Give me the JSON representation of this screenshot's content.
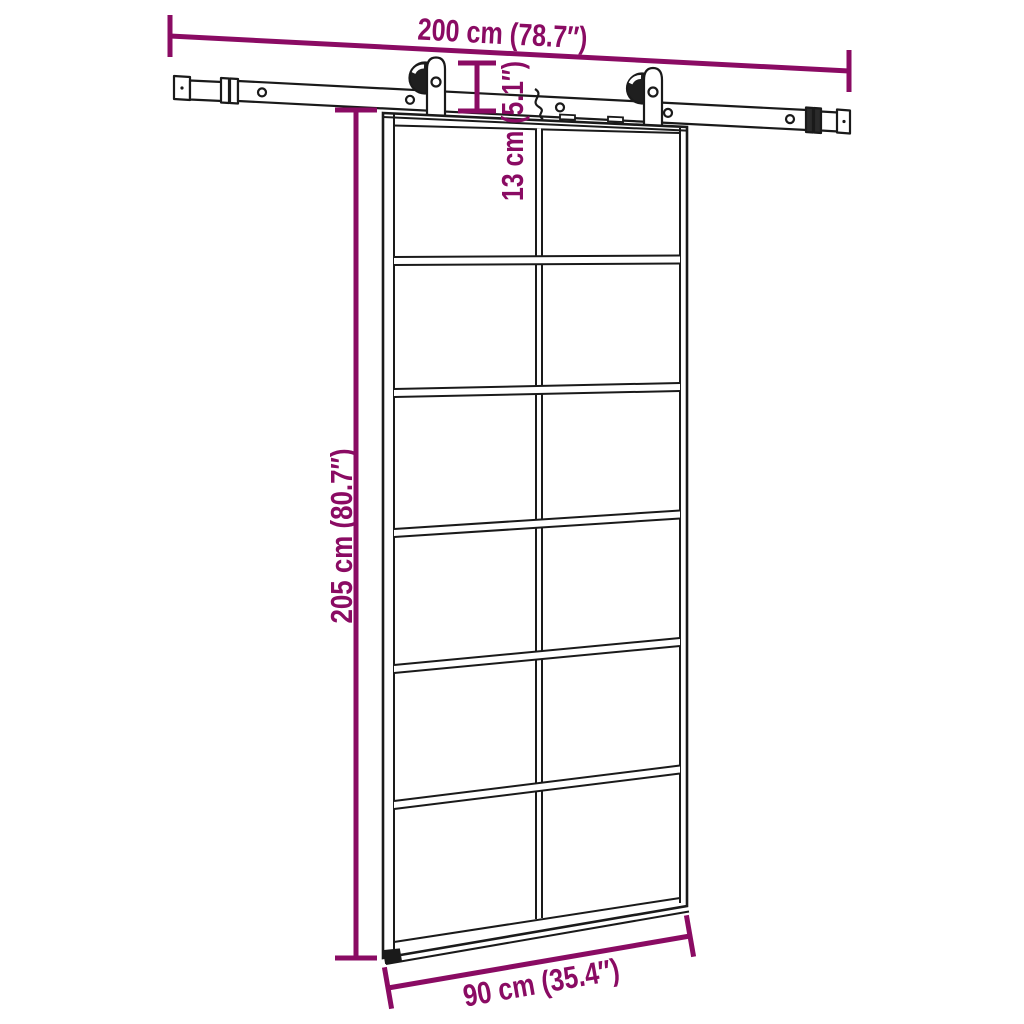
{
  "diagram": {
    "kind": "product-dimension-diagram",
    "subject": "sliding-glass-door-with-rail-hardware",
    "dimensions": {
      "rail_length": {
        "cm": 200,
        "inches": 78.7,
        "label": "200 cm (78.7″)"
      },
      "hanger_drop": {
        "cm": 13,
        "inches": 5.1,
        "label": "13 cm (5.1″)"
      },
      "door_height": {
        "cm": 205,
        "inches": 80.7,
        "label": "205 cm (80.7″)"
      },
      "door_width": {
        "cm": 90,
        "inches": 35.4,
        "label": "90 cm (35.4″)"
      }
    },
    "grid": {
      "pane_columns": 2,
      "pane_rows": 6
    },
    "colors": {
      "dimension_accent": "#8A0B63",
      "outline": "#1a1a1a",
      "background": "#ffffff"
    }
  }
}
